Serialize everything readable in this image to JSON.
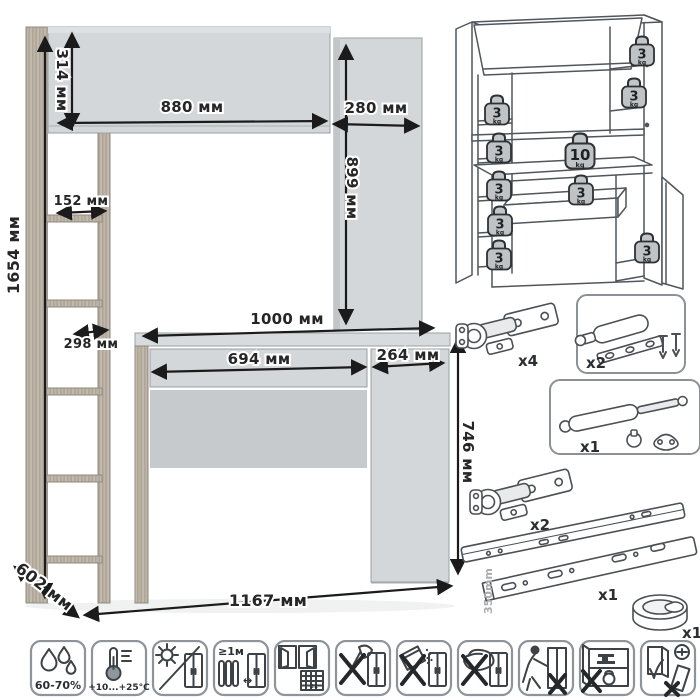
{
  "dimensions": {
    "total_height": "1654 мм",
    "hutch_height": "314 мм",
    "hutch_width": "880 мм",
    "side_cabinet_width": "280 мм",
    "side_cabinet_height": "899 мм",
    "shelf_width": "152 мм",
    "shelf_depth": "298 мм",
    "desktop_width": "1000 мм",
    "drawer_width": "694 мм",
    "door_width": "264 мм",
    "desk_height": "746 мм",
    "total_width": "1167 мм",
    "depth": "602 мм"
  },
  "load_diagram": {
    "weights": [
      {
        "value": "3",
        "unit": "kg"
      },
      {
        "value": "3",
        "unit": "kg"
      },
      {
        "value": "3",
        "unit": "kg"
      },
      {
        "value": "3",
        "unit": "kg"
      },
      {
        "value": "3",
        "unit": "kg"
      },
      {
        "value": "3",
        "unit": "kg"
      },
      {
        "value": "3",
        "unit": "kg"
      },
      {
        "value": "10",
        "unit": "kg"
      },
      {
        "value": "3",
        "unit": "kg"
      },
      {
        "value": "3",
        "unit": "kg"
      }
    ]
  },
  "hardware": {
    "hinges_top_count": "x4",
    "latch_count": "x2",
    "gas_lift_count": "x1",
    "hinges_bottom_count": "x2",
    "slides_count": "x1",
    "slides_length": "350mm",
    "grommet_count": "x1"
  },
  "care": {
    "humidity": "60-70%",
    "temperature": "+10...+25°C",
    "heat_distance": "≥1м",
    "ventilation_day": "21",
    "heat_arrow": "↔"
  },
  "colors": {
    "panel_gray": "#d3d7d9",
    "recess_gray": "#c6cacd",
    "wood": "#b7afa2",
    "line_black": "#1b1b1b"
  }
}
